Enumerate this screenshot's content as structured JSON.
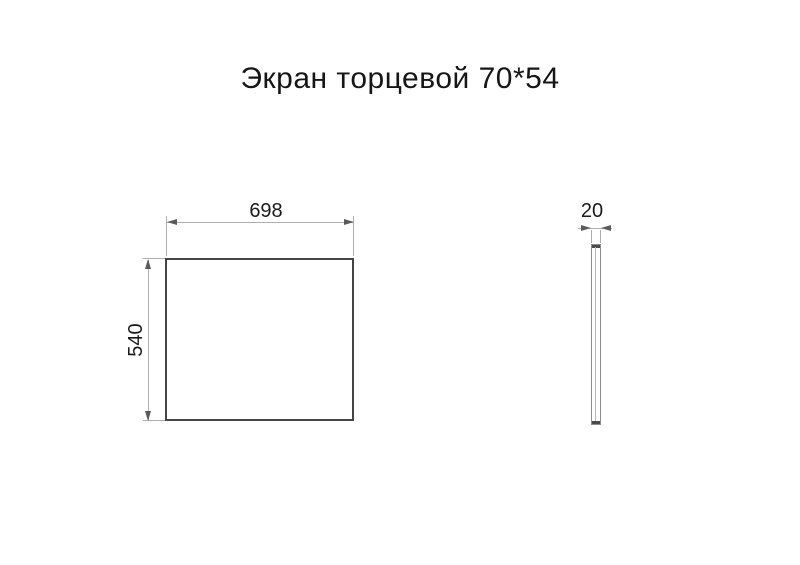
{
  "title": "Экран торцевой 70*54",
  "views": {
    "front": {
      "width_label": "698",
      "height_label": "540"
    },
    "side": {
      "thickness_label": "20"
    }
  },
  "colors": {
    "background": "#ffffff",
    "outline": "#454545",
    "dimension_line": "#aeaeae",
    "arrowhead": "#5a5a5a",
    "text": "#1a1a1a"
  }
}
